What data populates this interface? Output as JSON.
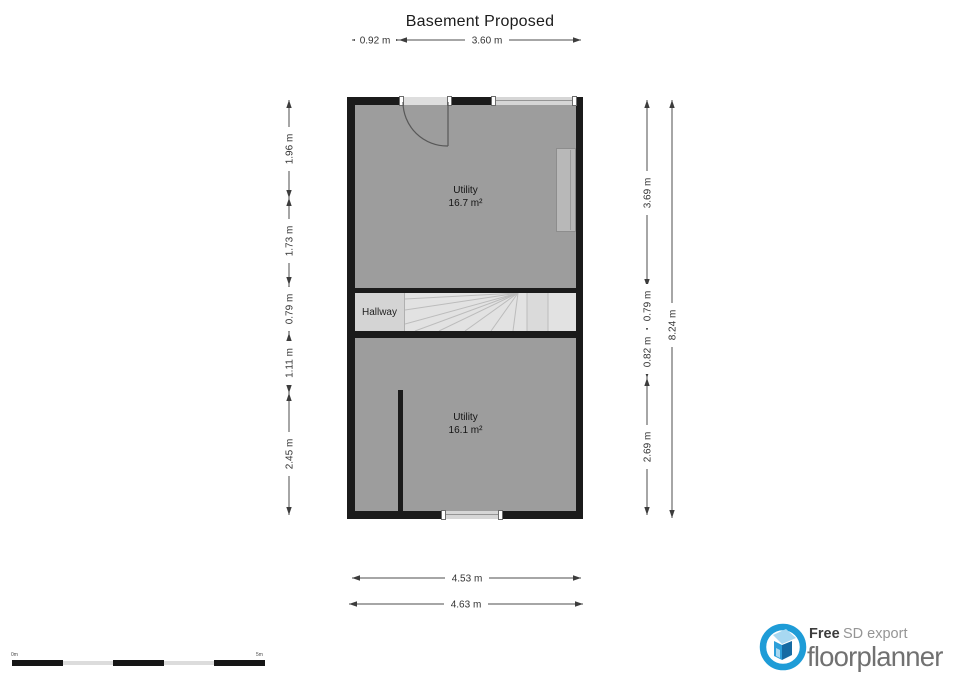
{
  "title": "Basement Proposed",
  "floorplan": {
    "room_top": {
      "name": "Utility",
      "area": "16.7 m²"
    },
    "hallway_label": "Hallway",
    "room_bottom": {
      "name": "Utility",
      "area": "16.1 m²"
    }
  },
  "dimensions": {
    "top": [
      "0.92 m",
      "3.60 m"
    ],
    "left": [
      "1.96 m",
      "1.73 m",
      "0.79 m",
      "1.11 m",
      "2.45 m"
    ],
    "right_inner": [
      "3.69 m",
      "0.79 m",
      "0.82 m",
      "2.69 m"
    ],
    "right_outer": "8.24 m",
    "bottom": [
      "4.53 m",
      "4.63 m"
    ]
  },
  "scale_bar": {
    "start": "0m",
    "end": "5m"
  },
  "logo": {
    "line1_bold": "Free",
    "line1_rest": " SD export",
    "brand": "floorplanner"
  },
  "colors": {
    "wall": "#1b1b1b",
    "room_fill": "#9d9d9d",
    "hallway_fill": "#e3e3e3",
    "dimension_line": "#4d4d4d",
    "logo_blue": "#1e9cd7",
    "logo_text": "#717171"
  }
}
